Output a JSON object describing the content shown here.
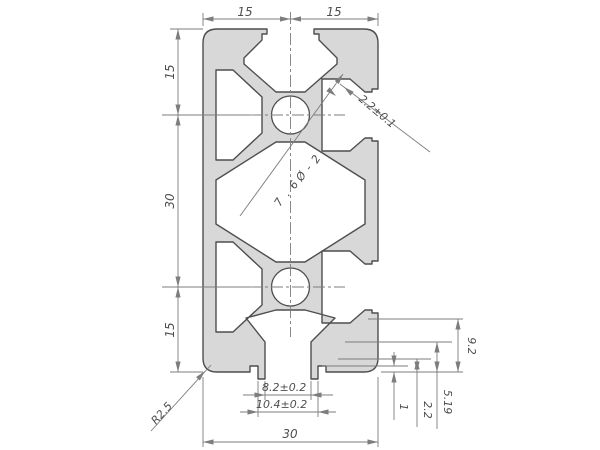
{
  "drawing_title": "aluminium-profile-30x60-cross-section",
  "dims": {
    "top_left_width": "15",
    "top_right_width": "15",
    "left_top_height": "15",
    "left_mid_height": "30",
    "left_bottom_height": "15",
    "slot_wall_thickness": "2.2±0.1",
    "hole_note": "2-Ø6.7",
    "hole_note_chars": [
      "2",
      "-",
      "Ø",
      "6",
      ".",
      "7"
    ],
    "corner_radius": "R2.5",
    "slot_opening_width": "8.2±0.2",
    "slot_outer_width": "10.4±0.2",
    "overall_width": "30",
    "step_9_2": "9.2",
    "step_5_19": "5.19",
    "step_2_2": "2.2",
    "step_1": "1"
  },
  "colors": {
    "profile_fill": "#d8d8d8",
    "outline": "#4e4e4e",
    "dimension_lines": "#7d7d7d",
    "text": "#4e4e4e",
    "background": "#ffffff"
  }
}
